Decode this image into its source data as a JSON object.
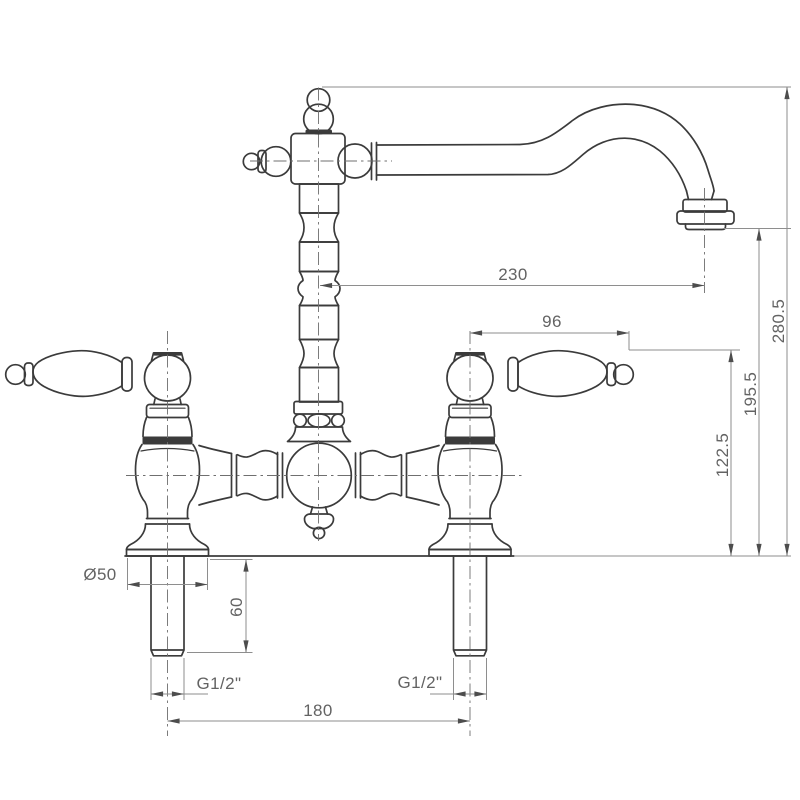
{
  "drawing": {
    "type": "technical-dimension-drawing",
    "subject": "two-handle bridge kitchen faucet, front elevation",
    "units": "mm",
    "labels": {
      "spout_reach": "230",
      "overall_height": "280.5",
      "spout_outlet_height": "195.5",
      "handle_top_height": "122.5",
      "handle_length": "96",
      "base_diameter": "Ø50",
      "shank_length": "60",
      "thread_size_left": "G1/2\"",
      "thread_size_right": "G1/2\"",
      "hole_centres": "180"
    },
    "colors": {
      "background": "#ffffff",
      "object_line": "#3b3b3b",
      "dimension_line": "#8e8e8e",
      "centerline": "#6f6f6f",
      "text": "#636363"
    }
  }
}
